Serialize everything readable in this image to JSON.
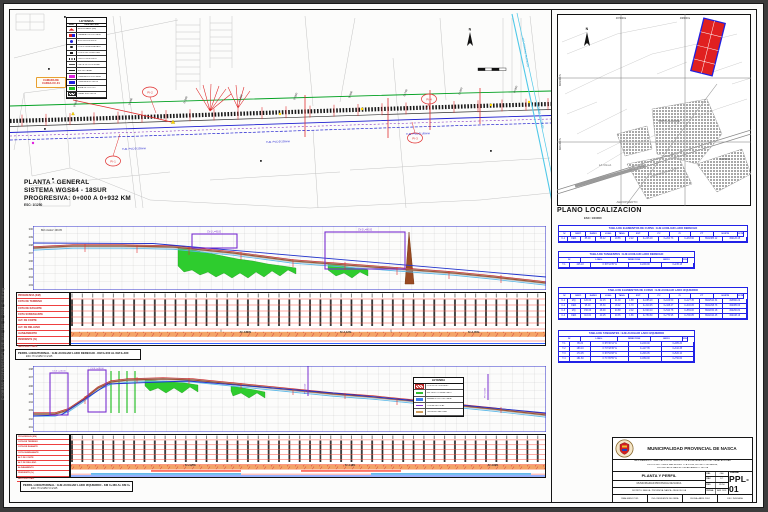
{
  "stamp": "D:\\OBRAS 2024\\NASCA\\PL_EJE-AUX_18S_TI_2024_C-08.dwg",
  "plan": {
    "title_lines": [
      "PLANTA - GENERAL",
      "SISTEMA WGS84 - 18SUR",
      "PROGRESIVA: 0+000 A 0+932 KM"
    ],
    "scale_note": "ESC: 1/1250",
    "north": "N",
    "callout_lines": [
      "CAMARA DE",
      "CARGA CC-01"
    ],
    "canal_label": "CANAL AUXILIAR",
    "river_label": "RIO TIERRAS BLANCAS",
    "stations": [
      "0+100",
      "0+200",
      "0+300",
      "0+400",
      "0+500",
      "0+600",
      "0+700",
      "0+800",
      "0+900"
    ],
    "pi": [
      "PI-1",
      "PI-2",
      "PI-3",
      "PI-4"
    ],
    "pipes": [
      "TUB. PVC Ø 200mm",
      "TUB. PVC Ø 200mm",
      "TUB. PVC Ø 160mm"
    ],
    "legend": {
      "title": "LEYENDA",
      "col_sym": "SIMB.",
      "col_desc": "DESCRIPCION",
      "rows": [
        {
          "s": "pl-bm",
          "t": "BENCH MARK (BM)"
        },
        {
          "s": "pl-cam",
          "t": "CAMARA PROYECTADA"
        },
        {
          "s": "pl-buz",
          "t": "BUZON EXISTENTE"
        },
        {
          "s": "pl-poste",
          "t": "POSTE DE ALUMBRADO"
        },
        {
          "s": "pl-tel",
          "t": "POSTE DE TELEFONIA"
        },
        {
          "s": "pl-cerco",
          "t": "CERCO EXISTENTE"
        },
        {
          "s": "pl-lim",
          "t": "LIMITE DE PROPIEDAD"
        },
        {
          "s": "pl-eje",
          "t": "EJE DE CANAL"
        },
        {
          "s": "pl-tubp",
          "t": "TUBERIA PROYECTADA"
        },
        {
          "s": "pl-tube",
          "t": "TUBERIA EXISTENTE"
        },
        {
          "s": "pl-verde",
          "t": "AREA DE CULTIVO"
        },
        {
          "s": "pl-pav",
          "t": "CANAL EXISTENTE"
        }
      ]
    }
  },
  "locmap": {
    "title": "PLANO LOCALIZACION",
    "scale": "ESC: 1/10000",
    "north": "N",
    "coords_top": [
      "497000 E",
      "498000 E"
    ],
    "coords_left": [
      "8942000 N",
      "8941000 N"
    ],
    "labels": {
      "a": "VISTA ALEGRE",
      "b": "NASCA",
      "c": "LA VILLA",
      "d": "AEROPUERTO",
      "e": "PANAMERICANA SUR"
    }
  },
  "tables": {
    "curve_cols": [
      "N°",
      "SENT.",
      "RADIO",
      "LONG.",
      "TANG.",
      "EXT.",
      "PC",
      "PI",
      "PT",
      "NORTE",
      "ESTE"
    ],
    "tan_cols": [
      "N°",
      "LONG.",
      "DIRECCION",
      "INICIO",
      "FIN"
    ],
    "curve_right": {
      "title": "TABLA DE ELEMENTOS DE CURVA : EJE AUXILIAR LADO DERECHO",
      "rows": [
        [
          "C-1",
          "DER.",
          "85.00",
          "38.42",
          "19.55",
          "2.22",
          "0+245.18",
          "0+264.73",
          "0+283.60",
          "8942385.12",
          "499126.45"
        ]
      ]
    },
    "tan_right": {
      "title": "TABLA DE TANGENTES : EJE AUXILIAR LADO DERECHO",
      "rows": [
        [
          "T-1",
          "245.18",
          "N 68°12'35\" E",
          "0+000.00",
          "0+245.18"
        ]
      ]
    },
    "curve_left": {
      "title": "TABLA DE ELEMENTOS DE CURVA : EJE AUXILIAR LADO IZQUIERDO",
      "rows": [
        [
          "C-1",
          "IZQ.",
          "120.00",
          "42.15",
          "21.30",
          "1.88",
          "0+085.20",
          "0+106.50",
          "0+127.35",
          "8942510.34",
          "498890.22"
        ],
        [
          "C-2",
          "DER.",
          "95.00",
          "35.60",
          "18.02",
          "1.70",
          "0+310.45",
          "0+328.47",
          "0+346.05",
          "8942298.76",
          "499085.60"
        ],
        [
          "C-3",
          "IZQ.",
          "150.00",
          "48.90",
          "24.68",
          "2.02",
          "0+520.10",
          "0+544.78",
          "0+569.00",
          "8942150.18",
          "499260.84"
        ],
        [
          "C-4",
          "DER.",
          "110.00",
          "40.25",
          "20.35",
          "1.86",
          "0+750.60",
          "0+770.95",
          "0+790.85",
          "8942010.45",
          "499438.19"
        ]
      ]
    },
    "tan_left": {
      "title": "TABLA DE TANGENTES : EJE AUXILIAR LADO IZQUIERDO",
      "rows": [
        [
          "T-1",
          "85.20",
          "N 65°30'12\" E",
          "0+000.00",
          "0+085.20"
        ],
        [
          "T-2",
          "183.10",
          "N 70°18'45\" E",
          "0+127.35",
          "0+310.45"
        ],
        [
          "T-3",
          "174.05",
          "N 66°52'08\" E",
          "0+346.05",
          "0+520.10"
        ],
        [
          "T-4",
          "181.60",
          "N 71°05'55\" E",
          "0+569.00",
          "0+750.60"
        ]
      ]
    }
  },
  "profiles": {
    "band_labels": [
      "PROGRESIVA (KM)",
      "COTA DE TERRENO",
      "COTA DE RASANTE",
      "COTA SUBRASANTE",
      "ALT. DE CORTE",
      "ALT. DE RELLENO",
      "ALINEAMIENTO",
      "PENDIENTE (%)",
      "SECCION / OBS."
    ],
    "upper": {
      "bm": "BM-1 ELEV. 299.85",
      "cv1": "CV-1 L=45.00",
      "cv2": "CV-2 L=80.00",
      "grades": [
        "S=-0.85%",
        "S=-1.12%",
        "S=-1.45%"
      ],
      "elev": [
        "300",
        "299",
        "298",
        "297",
        "296",
        "295",
        "294",
        "293"
      ]
    },
    "lower": {
      "cv1": "CV-3 L=30.00",
      "cv2": "CV-4 L=30.00",
      "piv1": "PIV 0+610",
      "piv2": "PIV 0+835",
      "grades": [
        "S=+4.25%",
        "S=-1.18%",
        "S=-1.62%"
      ],
      "elev": [
        "298",
        "297",
        "296",
        "295",
        "294",
        "293",
        "292",
        "291"
      ]
    },
    "legend": {
      "title": "LEYENDA",
      "rows": [
        {
          "s": "ps-cut",
          "t": "CORTE DE TERRENO"
        },
        {
          "s": "ps-fill",
          "t": "RELLENO COMPACTADO"
        },
        {
          "s": "ps-ras",
          "t": "RASANTE PROYECTADA"
        },
        {
          "s": "ps-cv",
          "t": "CURVA VERTICAL"
        },
        {
          "s": "ps-ter",
          "t": "TERRENO NATURAL"
        }
      ]
    },
    "sub1": {
      "l1": "PERFIL LONGITUDINAL : EJE AUXILIAR LADO DERECHO - KM 0+000 AL KM 0+460",
      "l2": "ESC: H=1/1250  V=1/125"
    },
    "sub2": {
      "l1": "PERFIL LONGITUDINAL : EJE AUXILIAR LADO IZQUIERDO - KM 0+460 AL KM 0+932",
      "l2": "ESC: H=1/1250  V=1/125"
    }
  },
  "titleblock": {
    "org": "MUNICIPALIDAD PROVINCIAL DE NASCA",
    "project_lines": [
      "MEJORAMIENTO Y AMPLIACION DEL SERVICIO DE AGUA PARA RIEGO DEL CANAL AUXILIAR",
      "EN LOS SECTORES SAN MIGUEL Y LA VILLA, DISTRITO DE NASCA,",
      "PROVINCIA DE NASCA - DEPARTAMENTO DE ICA"
    ],
    "sheet_title": "PLANTA Y PERFIL",
    "entity": "MUNICIPALIDAD PROVINCIAL DE NASCA",
    "location": "DISTRITO: NASCA - PROVINCIA: NASCA - REGION: ICA",
    "mini": [
      [
        "DIB:",
        "CAD"
      ],
      [
        "REV:",
        "R.T."
      ],
      [
        "ESC:",
        "1/1250"
      ],
      [
        "FECHA:",
        "ABR. 2024"
      ]
    ],
    "lamina_label": "LAMINA:",
    "lamina": "PPL-01",
    "bottom_cells": [
      "REALIZADO POR:",
      "ING. RESIDENTE DE OBRA",
      "FECHA: ABRIL 2024",
      "ESC: INDICADA"
    ]
  }
}
